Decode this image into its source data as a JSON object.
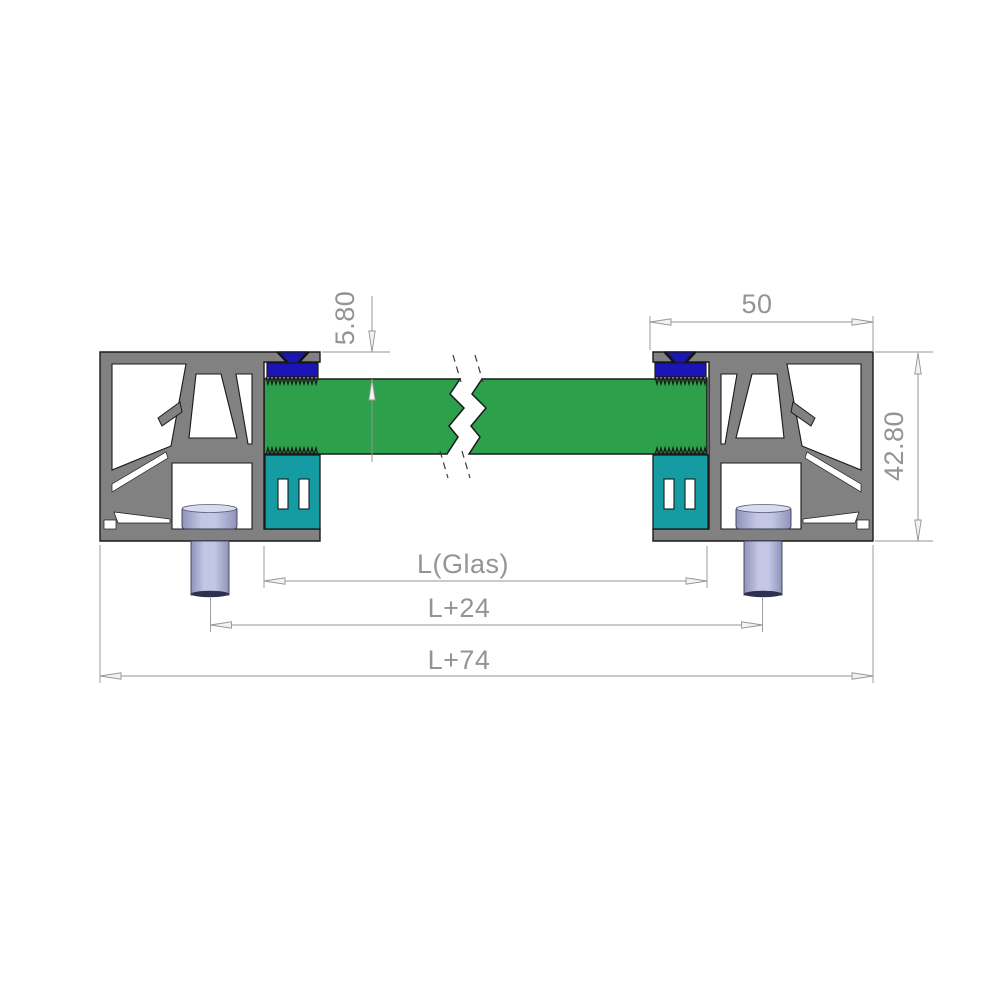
{
  "drawing": {
    "kind": "glass-clamp-profile-cross-section",
    "dimensions": {
      "glass_offset_top": "5.80",
      "profile_width": "50",
      "profile_height": "42.80",
      "glass_length": "L(Glas)",
      "length_plus_24": "L+24",
      "length_plus_74": "L+74"
    },
    "components": {
      "frame_profile": "aluminium-frame-profile",
      "glass_panel": "glass-panel",
      "wedge_gasket": "wedge-gasket",
      "glazing_block": "glazing-block",
      "fastening_bolt": "fastening-bolt"
    },
    "colors": {
      "profile": "#818181",
      "glass": "#2CA04B",
      "gasket": "#1A15B4",
      "block": "#149CA2",
      "bolt": "#C3C6E4",
      "dim": "#949494",
      "outline": "#1A1A1A",
      "bg": "#FFFFFF"
    }
  }
}
